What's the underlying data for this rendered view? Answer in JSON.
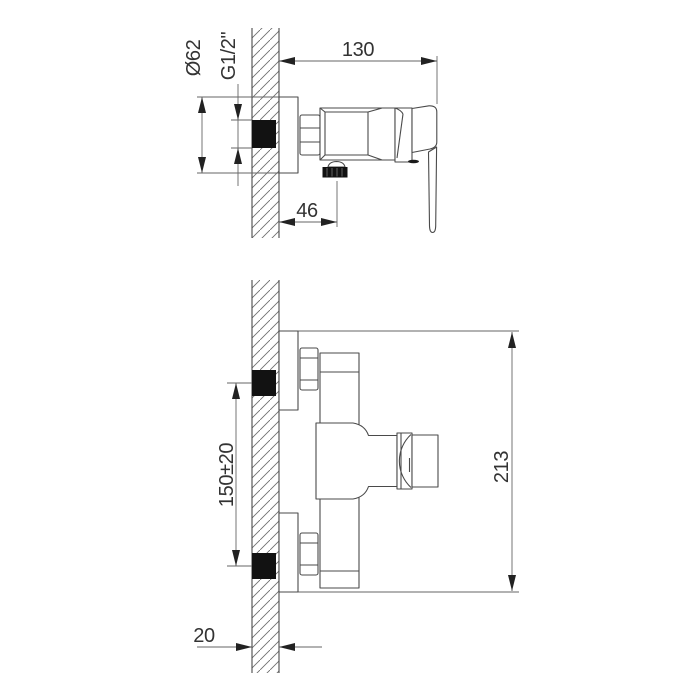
{
  "colors": {
    "background": "#ffffff",
    "object_line": "#4a4a4a",
    "dimension_line": "#666666",
    "solid_fill": "#121212",
    "text": "#333333"
  },
  "views": {
    "top": {
      "dims": {
        "depth": "130",
        "flange_diameter": "Ø62",
        "thread": "G1/2\"",
        "outlet_offset": "46"
      }
    },
    "bottom": {
      "dims": {
        "inlet_spacing": "150±20",
        "total_height": "213",
        "wall_thickness": "20"
      }
    }
  }
}
